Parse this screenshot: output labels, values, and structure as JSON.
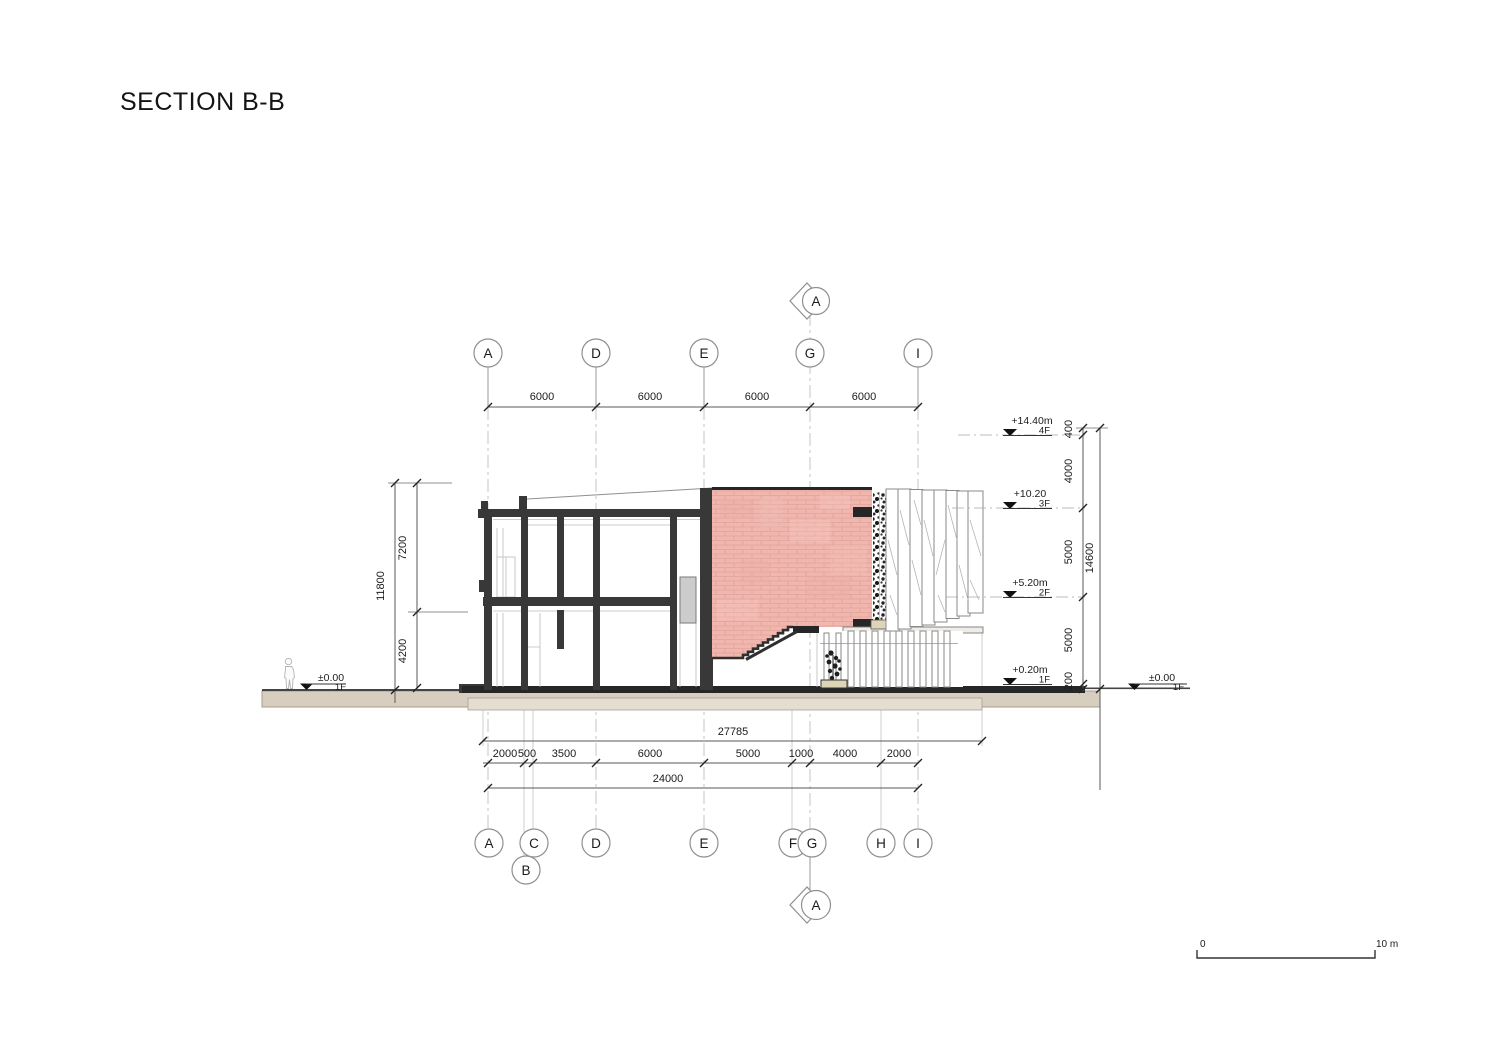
{
  "title": "SECTION B-B",
  "grids": {
    "top": [
      "A",
      "D",
      "E",
      "G",
      "I"
    ],
    "bottom": [
      "A",
      "C",
      "D",
      "E",
      "F",
      "G",
      "H",
      "I"
    ],
    "bottom_offset": "B",
    "section_marker": "A"
  },
  "dimensions": {
    "top_spacings": [
      "6000",
      "6000",
      "6000",
      "6000"
    ],
    "left": {
      "total": "11800",
      "upper": "7200",
      "lower": "4200"
    },
    "right": {
      "segments": [
        "400",
        "4000",
        "5000",
        "5000",
        "200"
      ],
      "total": "14600"
    },
    "bottom": {
      "row1_total": "27785",
      "row2": [
        "2000",
        "500",
        "3500",
        "6000",
        "5000",
        "1000",
        "4000",
        "2000"
      ],
      "row3_total": "24000"
    }
  },
  "levels": [
    {
      "floor": "4F",
      "elevation": "+14.40m"
    },
    {
      "floor": "3F",
      "elevation": "+10.20"
    },
    {
      "floor": "2F",
      "elevation": "+5.20m"
    },
    {
      "floor": "1F",
      "elevation": "+0.20m"
    }
  ],
  "ground_markers": {
    "left": {
      "elevation": "±0.00",
      "floor": "1F"
    },
    "right": {
      "elevation": "±0.00",
      "floor": "1F"
    }
  },
  "scale_bar": {
    "start": "0",
    "end": "10 m"
  },
  "colors": {
    "hatch_pink": "#f1b6ae",
    "hatch_line": "#dfa49c",
    "ground_beige": "#d8cec0",
    "foundation_beige": "#e5ddcf",
    "cut_dark": "#383838"
  }
}
